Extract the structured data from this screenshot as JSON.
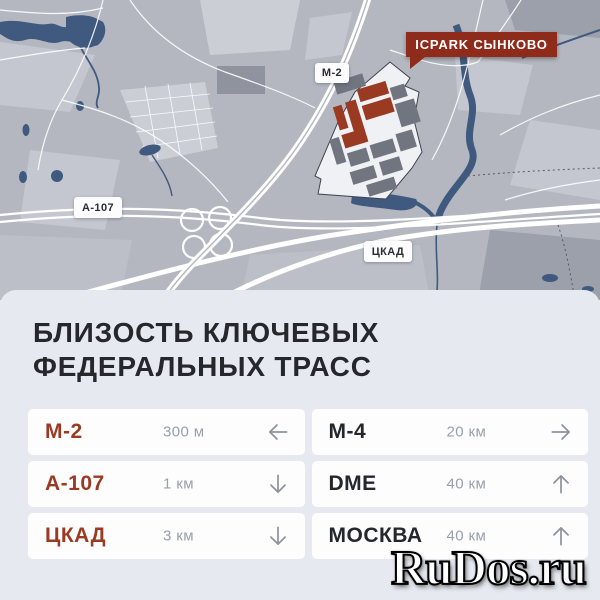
{
  "colors": {
    "accent_red": "#9B3A23",
    "badge_red": "#8E2B1A",
    "water": "#40597F",
    "map_bg": "#B4B7C0",
    "panel_bg": "#E6E9F0",
    "card_bg": "#FDFDFE",
    "text_dark": "#26272C",
    "text_muted": "#99A0AA",
    "arrow_gray": "#8F939D"
  },
  "map": {
    "project_label": "ICPARK СЫНКОВО",
    "road_labels": {
      "m2": "М-2",
      "a107": "А-107",
      "ckad": "ЦКАД"
    }
  },
  "section": {
    "title_line1": "БЛИЗОСТЬ КЛЮЧЕВЫХ",
    "title_line2": "ФЕДЕРАЛЬНЫХ ТРАСС",
    "cards": [
      {
        "label": "М-2",
        "distance": "300 м",
        "direction": "left",
        "highlight": true
      },
      {
        "label": "М-4",
        "distance": "20 км",
        "direction": "right",
        "highlight": false
      },
      {
        "label": "А-107",
        "distance": "1 км",
        "direction": "down",
        "highlight": true
      },
      {
        "label": "DME",
        "distance": "40 км",
        "direction": "up",
        "highlight": false
      },
      {
        "label": "ЦКАД",
        "distance": "3 км",
        "direction": "down",
        "highlight": true
      },
      {
        "label": "МОСКВА",
        "distance": "40 км",
        "direction": "up",
        "highlight": false
      }
    ]
  },
  "watermark": "RuDos.ru"
}
